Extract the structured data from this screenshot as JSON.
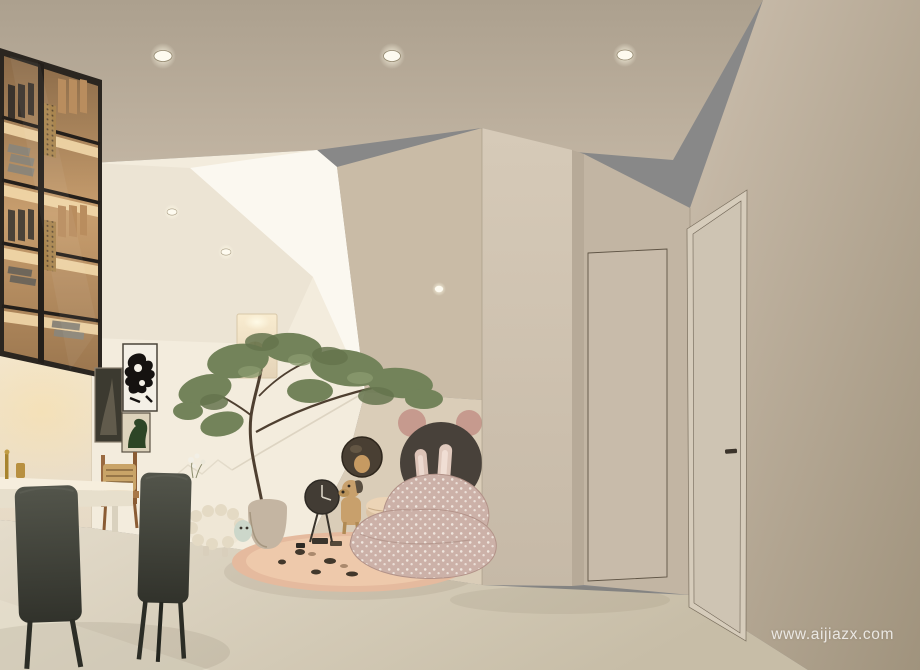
{
  "watermark": {
    "text": "www.aijiazx.com"
  },
  "palette": {
    "ceiling_top": "#aca08e",
    "ceiling_bottom": "#c1b4a2",
    "wall_right_top": "#ccbfae",
    "wall_right_bottom": "#a0937d",
    "wall_hall": "#c2b5a3",
    "hidden_panel": "#c8bbaa",
    "column_front": "#cfc3b1",
    "column_side": "#b7aa98",
    "stair_beige": "#c9bba6",
    "play_wall": "#dacdb8",
    "white_soft": "#f3ecdd",
    "white_bright": "#fbf8f0",
    "soffit": "#ece4d4",
    "warm_wall": "#efe3cd",
    "floor_light": "#e4dccb",
    "floor_dark": "#c7bda7",
    "shelf_frame": "#2b2620",
    "shelf_wood": "#b98d5e",
    "shelf_glow": "#f6ddae",
    "door_face": "#cec4b3",
    "door_frame": "#d6ccbb",
    "door_handle": "#3b342b",
    "chair_dark": "#45463e",
    "table_top": "#f6eedd",
    "rug": "#e5ba9e",
    "beanbag": "#ccb1a8",
    "circle_dark": "#48413a",
    "ear_pink": "#c69a8e",
    "tree_green": "#73835a",
    "art_black": "#151210",
    "art_green": "#2d4526",
    "sheep_body": "#efe7d6",
    "toy_wood": "#c8a06c"
  },
  "objects": [
    "ceiling-downlights",
    "glass-front-bookshelf",
    "framed-wall-art",
    "dining-table-and-chairs",
    "staircase-void",
    "wall-niche-with-rattan-ball",
    "indoor-tree",
    "sheep-plush-toy",
    "kids-play-rug",
    "floor-clock",
    "round-wall-mirror",
    "mouse-wall-circles",
    "wooden-dog-toy",
    "bunny-ear-bean-bag",
    "structural-column",
    "concealed-door-panel",
    "entry-door"
  ]
}
